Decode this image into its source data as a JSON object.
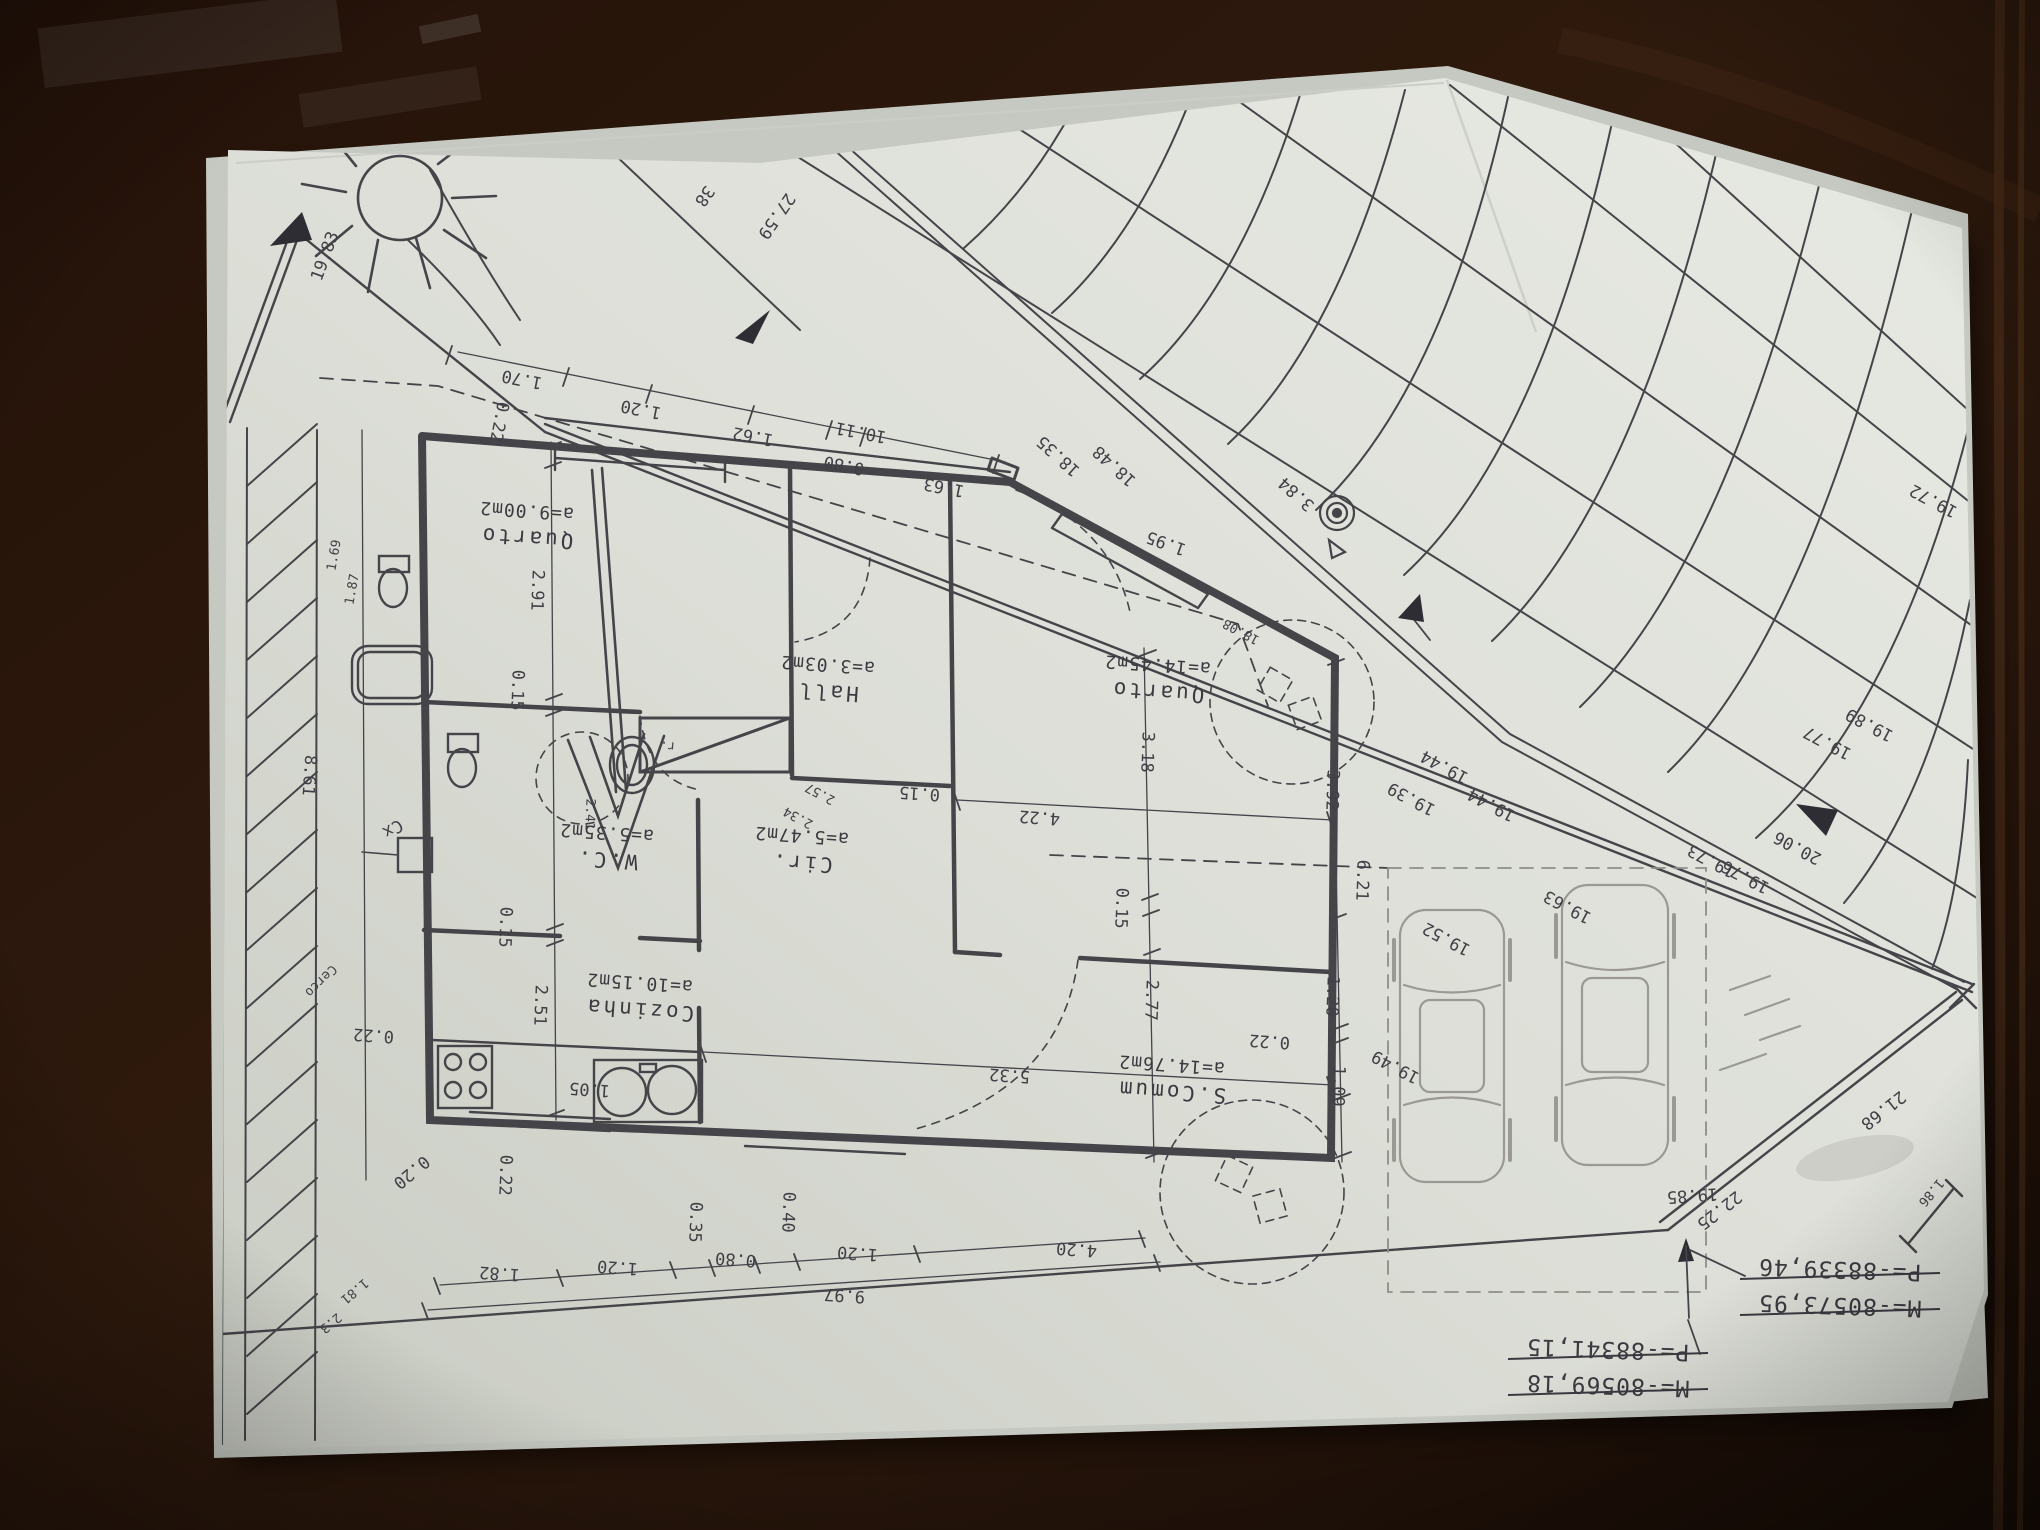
{
  "meta": {
    "description": "Photograph of a printed architectural site / floor plan laid upside-down on a dark wooden table",
    "language": "Portuguese"
  },
  "colors": {
    "paper": "#dfe1da",
    "paper_shadowed": "#c7cac2",
    "ink": "#454449",
    "pencil": "#9b9994",
    "wood_dark": "#170d07",
    "wood_mid": "#33190d",
    "wood_light": "#5c3a22"
  },
  "plan": {
    "rooms": [
      {
        "name": "Quarto",
        "area": "a=9.00m2",
        "x": 527,
        "y": 531
      },
      {
        "name": "Hall",
        "area": "a=3.03m2",
        "x": 828,
        "y": 685
      },
      {
        "name": "Quarto",
        "area": "a=14.45m2",
        "x": 1158,
        "y": 685
      },
      {
        "name": "W.C.",
        "area": "a=5.35m2",
        "x": 607,
        "y": 853
      },
      {
        "name": "Cir.",
        "area": "a=5.47m2",
        "x": 802,
        "y": 856
      },
      {
        "name": "Cozinha",
        "area": "a=10.15m2",
        "x": 640,
        "y": 1003
      },
      {
        "name": "S.Comum",
        "area": "a=14.76m2",
        "x": 1172,
        "y": 1085
      }
    ],
    "labels": [
      {
        "t": "1.70",
        "x": 523,
        "y": 374,
        "a": 191
      },
      {
        "t": "1.20",
        "x": 642,
        "y": 404,
        "a": 191
      },
      {
        "t": "1.62",
        "x": 754,
        "y": 431,
        "a": 191
      },
      {
        "t": "10.11",
        "x": 862,
        "y": 427,
        "a": 191
      },
      {
        "t": "0.80",
        "x": 845,
        "y": 460,
        "a": 191
      },
      {
        "t": "1.63",
        "x": 945,
        "y": 482,
        "a": 191
      },
      {
        "t": "1.95",
        "x": 1168,
        "y": 538,
        "a": 200
      },
      {
        "t": "0.22",
        "x": 494,
        "y": 421,
        "a": 101
      },
      {
        "t": "2.91",
        "x": 532,
        "y": 590,
        "a": 92
      },
      {
        "t": "0.15",
        "x": 512,
        "y": 690,
        "a": 92
      },
      {
        "t": "0.15",
        "x": 500,
        "y": 927,
        "a": 92
      },
      {
        "t": "2.51",
        "x": 535,
        "y": 1005,
        "a": 92
      },
      {
        "t": "0.22",
        "x": 500,
        "y": 1175,
        "a": 92
      },
      {
        "t": "8.61",
        "x": 304,
        "y": 775,
        "a": 94
      },
      {
        "t": "3.18",
        "x": 1142,
        "y": 752,
        "a": 92
      },
      {
        "t": "2.77",
        "x": 1146,
        "y": 1000,
        "a": 92
      },
      {
        "t": "0.15",
        "x": 1116,
        "y": 908,
        "a": 92
      },
      {
        "t": "3.92",
        "x": 1327,
        "y": 790,
        "a": 92
      },
      {
        "t": "6.21",
        "x": 1357,
        "y": 880,
        "a": 92
      },
      {
        "t": "1.20",
        "x": 1327,
        "y": 996,
        "a": 92
      },
      {
        "t": "1.09",
        "x": 1333,
        "y": 1086,
        "a": 92
      },
      {
        "t": "0.35",
        "x": 690,
        "y": 1222,
        "a": 92
      },
      {
        "t": "0.40",
        "x": 783,
        "y": 1212,
        "a": 92
      },
      {
        "t": "2.41",
        "x": 586,
        "y": 814,
        "a": 92,
        "cls": "sm"
      },
      {
        "t": "0.15",
        "x": 920,
        "y": 788,
        "a": 184
      },
      {
        "t": "4.22",
        "x": 1040,
        "y": 812,
        "a": 184
      },
      {
        "t": "0.22",
        "x": 1270,
        "y": 1036,
        "a": 184
      },
      {
        "t": "5.32",
        "x": 1010,
        "y": 1070,
        "a": 184
      },
      {
        "t": "1.05",
        "x": 590,
        "y": 1084,
        "a": 184
      },
      {
        "t": "0.22",
        "x": 374,
        "y": 1030,
        "a": 184
      },
      {
        "t": "0.20",
        "x": 408,
        "y": 1168,
        "a": 140
      },
      {
        "t": "1.82",
        "x": 500,
        "y": 1268,
        "a": 184
      },
      {
        "t": "1.20",
        "x": 618,
        "y": 1262,
        "a": 184
      },
      {
        "t": "0.80",
        "x": 736,
        "y": 1254,
        "a": 184
      },
      {
        "t": "1.20",
        "x": 858,
        "y": 1248,
        "a": 184
      },
      {
        "t": "4.20",
        "x": 1077,
        "y": 1244,
        "a": 184
      },
      {
        "t": "9.97",
        "x": 845,
        "y": 1290,
        "a": 184
      },
      {
        "t": "19.83",
        "x": 330,
        "y": 258,
        "a": 290
      },
      {
        "t": "1.69",
        "x": 338,
        "y": 556,
        "a": 280,
        "cls": "sm"
      },
      {
        "t": "1.87",
        "x": 356,
        "y": 590,
        "a": 280,
        "cls": "sm"
      },
      {
        "t": "18.35",
        "x": 1062,
        "y": 452,
        "a": 222
      },
      {
        "t": "18.48",
        "x": 1118,
        "y": 462,
        "a": 222
      },
      {
        "t": "3.84",
        "x": 1300,
        "y": 490,
        "a": 222
      },
      {
        "t": "18.08",
        "x": 1243,
        "y": 628,
        "a": 208,
        "cls": "sm"
      },
      {
        "t": "27.59",
        "x": 772,
        "y": 213,
        "a": 125
      },
      {
        "t": "38",
        "x": 700,
        "y": 193,
        "a": 125
      },
      {
        "t": "19.44",
        "x": 1447,
        "y": 762,
        "a": 208
      },
      {
        "t": "19.39",
        "x": 1414,
        "y": 794,
        "a": 208
      },
      {
        "t": "19.44",
        "x": 1494,
        "y": 800,
        "a": 208
      },
      {
        "t": "19.52",
        "x": 1449,
        "y": 934,
        "a": 208
      },
      {
        "t": "19.63",
        "x": 1570,
        "y": 902,
        "a": 208
      },
      {
        "t": "19.49",
        "x": 1398,
        "y": 1062,
        "a": 208
      },
      {
        "t": "19.73",
        "x": 1714,
        "y": 856,
        "a": 208
      },
      {
        "t": "19.76",
        "x": 1748,
        "y": 872,
        "a": 208
      },
      {
        "t": "19.72",
        "x": 1936,
        "y": 496,
        "a": 208
      },
      {
        "t": "19.77",
        "x": 1830,
        "y": 738,
        "a": 208
      },
      {
        "t": "19.89",
        "x": 1872,
        "y": 720,
        "a": 208
      },
      {
        "t": "20.06",
        "x": 1800,
        "y": 843,
        "a": 208
      },
      {
        "t": "19.85",
        "x": 1692,
        "y": 1190,
        "a": 176
      },
      {
        "t": "22.25",
        "x": 1716,
        "y": 1206,
        "a": 142
      },
      {
        "t": "21.68",
        "x": 1880,
        "y": 1106,
        "a": 142
      },
      {
        "t": "1.86",
        "x": 1928,
        "y": 1190,
        "a": 130,
        "cls": "sm"
      },
      {
        "t": "1.81",
        "x": 352,
        "y": 1288,
        "a": 140,
        "cls": "sm"
      },
      {
        "t": "2.3",
        "x": 328,
        "y": 1320,
        "a": 140,
        "cls": "sm"
      },
      {
        "t": "Cx",
        "x": 390,
        "y": 824,
        "a": 150
      },
      {
        "t": "Cerco",
        "x": 318,
        "y": 978,
        "a": 135,
        "cls": "sm"
      },
      {
        "t": "r.",
        "x": 668,
        "y": 742,
        "a": 184,
        "cls": "sm"
      },
      {
        "t": "2.57",
        "x": 822,
        "y": 790,
        "a": 208,
        "cls": "sm"
      },
      {
        "t": "2.34",
        "x": 800,
        "y": 814,
        "a": 208,
        "cls": "sm"
      }
    ],
    "coordinate_points": [
      {
        "m": "M=-80573,95",
        "p": "P=-88339,46",
        "x": 1840,
        "y": 1262
      },
      {
        "m": "M=-80569,18",
        "p": "P=-88341,15",
        "x": 1608,
        "y": 1342
      }
    ],
    "symbols": [
      {
        "name": "sun-icon"
      },
      {
        "name": "north-arrow-icon"
      },
      {
        "name": "survey-marker-icon"
      },
      {
        "name": "boundary-arrow-icon"
      },
      {
        "name": "tree-icon"
      },
      {
        "name": "car-outline"
      },
      {
        "name": "utility-box-cx"
      }
    ]
  }
}
